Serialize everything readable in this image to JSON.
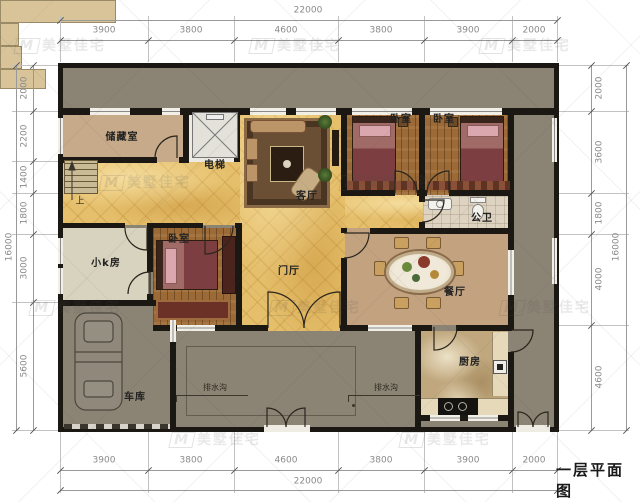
{
  "title": "一层平面图",
  "watermark": {
    "logo": "M",
    "text": "美墅佳宅"
  },
  "dimensions": {
    "horizontal": {
      "total": "22000",
      "segments": [
        "3900",
        "3800",
        "4600",
        "3800",
        "3900",
        "2000"
      ]
    },
    "left": {
      "total": "16000",
      "segments": [
        "2000",
        "2200",
        "1400",
        "1800",
        "3000",
        "5600"
      ]
    },
    "right": {
      "total": "16000",
      "segments": [
        "2000",
        "3600",
        "1800",
        "4000",
        "4600"
      ]
    }
  },
  "rooms": {
    "storage": {
      "label": "储藏室"
    },
    "elevator": {
      "label": "电梯"
    },
    "living_room": {
      "label": "客厅"
    },
    "bedroom_top_left": {
      "label": "卧室"
    },
    "bedroom_top_right": {
      "label": "卧室"
    },
    "bedroom_west": {
      "label": "卧室"
    },
    "public_bath": {
      "label": "公卫"
    },
    "k_room": {
      "label": "小k房"
    },
    "foyer": {
      "label": "门厅"
    },
    "dining_room": {
      "label": "餐厅"
    },
    "kitchen": {
      "label": "厨房"
    },
    "garage": {
      "label": "车库"
    }
  },
  "annotations": {
    "stairs_up": "上",
    "drain_left": "排水沟",
    "drain_right": "排水沟"
  },
  "colors": {
    "wall": "#1b1712",
    "outdoor_gray": "#8b8374",
    "marble_gold": "#e5bf6b",
    "wood_floor": "#9b6a37",
    "storage_tan": "#c6aa89",
    "dining_tan": "#c2a27f",
    "k_room_beige": "#d8d3be",
    "bath_tile": "#ded3c0",
    "kitchen_marble": "#c0a77d",
    "step_tan": "#d9c49a"
  }
}
